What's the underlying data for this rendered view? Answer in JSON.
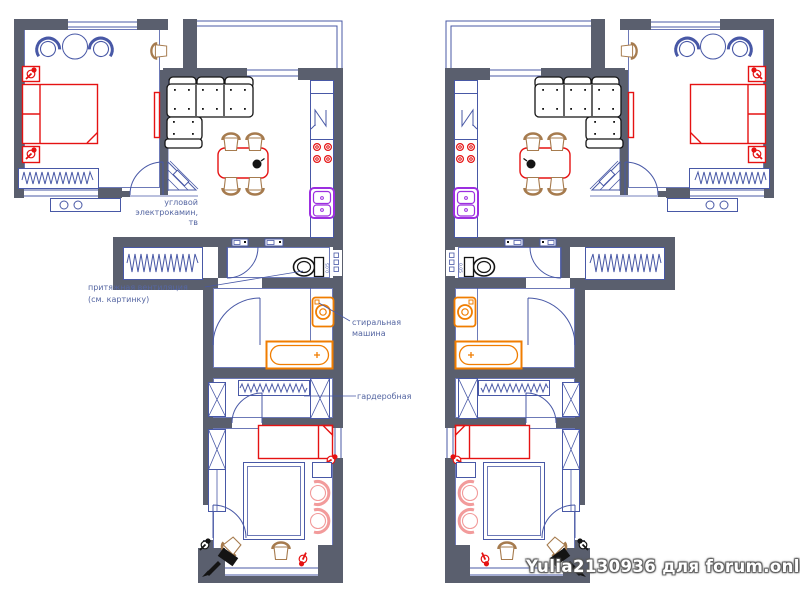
{
  "image": {
    "description": "Two mirrored apartment floor plan variants",
    "background": "#ffffff"
  },
  "watermark": {
    "text": "Yulia2130936 для forum.onliner.by"
  },
  "annotations": {
    "fireplace": {
      "line1": "угловой",
      "line2": "электрокамин,",
      "line3": "тв"
    },
    "ventilation": {
      "line1": "притяжная вентиляция",
      "line2": "(см. картинку)"
    },
    "washing_machine": {
      "line1": "стиральная",
      "line2": "машина"
    },
    "wardrobe": {
      "label": "гардеробная"
    },
    "toilet_tank": {
      "label": "0.05"
    }
  },
  "colors": {
    "wall": "#5a5f6e",
    "line": "#4858a6",
    "red": "#e51212",
    "orange": "#f07d00",
    "purple": "#9c2ee0",
    "tan": "#a67b4e",
    "pink": "#f29b9b",
    "black": "#141414",
    "text": "#5566a2",
    "watermark_fill": "#ffffff",
    "watermark_shadow": "#5a5a5a"
  }
}
